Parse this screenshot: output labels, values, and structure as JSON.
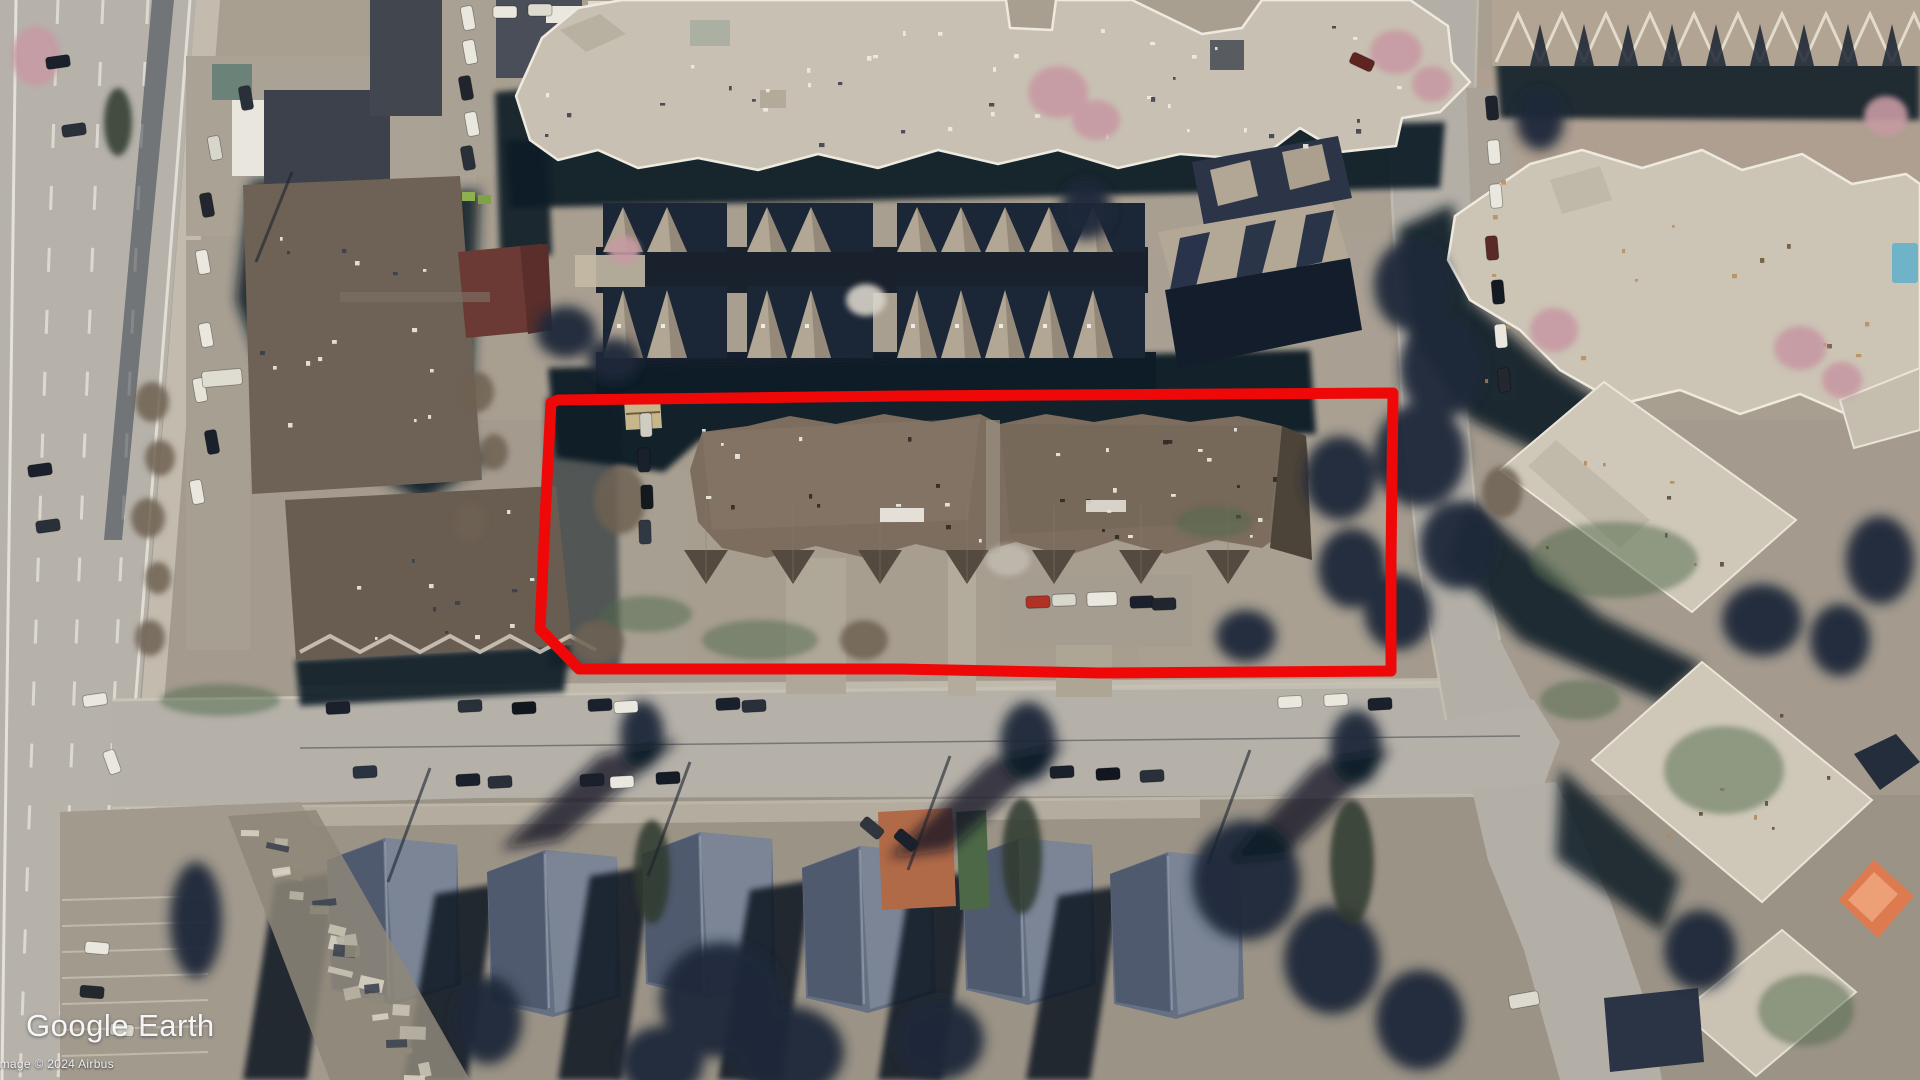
{
  "app": {
    "name": "Google Earth"
  },
  "overlay": {
    "logo_text": "Google Earth",
    "attribution": "Image © 2024 Airbus"
  },
  "annotation": {
    "type": "hand-drawn polygon outline",
    "color": "#ee0808",
    "target": "central apartment complex parcel"
  },
  "scene": {
    "description": "Oblique aerial/satellite view of a suburban block: multi-lane highway on the left, commercial buildings with parking, rows of townhouses, a large brown-roofed condominium outlined in red, a tree-lined street with parked cars below it, and tan apartment buildings with a pool to the right."
  }
}
